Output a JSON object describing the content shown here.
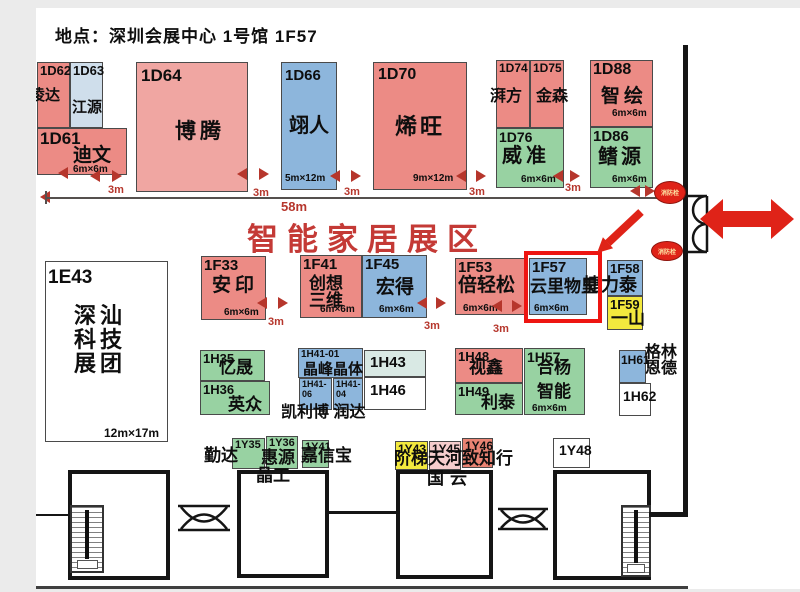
{
  "title": "地点：深圳会展中心 1号馆 1F57",
  "banner": {
    "text": "智能家居展区"
  },
  "fire_hydrant_label": "消防栓",
  "highlight": {
    "booth": "1F57",
    "x": 524,
    "y": 251,
    "w": 78,
    "h": 72
  },
  "colors": {
    "salmon": "#ec8b85",
    "salmon_light": "#f0a6a2",
    "salmon_deep": "#e98373",
    "blue": "#8db6dc",
    "paleblue": "#cfdeeb",
    "palecyan": "#d9e9e4",
    "green": "#98d2a2",
    "yellow": "#f3e93e",
    "palepink": "#f6cdcd",
    "white": "#ffffff",
    "accent_red": "#df2318",
    "dim_red": "#b6362c",
    "banner_red": "#c43a36",
    "highlight_red": "#ee1511"
  },
  "booths": [
    {
      "id": "1D62",
      "nm": "凌达",
      "c": "salmon",
      "x": 37,
      "y": 62,
      "w": 33,
      "h": 66,
      "ifs": 13,
      "nfs": 15,
      "nx": -8,
      "ny": 25
    },
    {
      "id": "1D63",
      "nm": "江源",
      "c": "paleblue",
      "x": 70,
      "y": 62,
      "w": 33,
      "h": 66,
      "ifs": 13,
      "nfs": 15,
      "nx": 1,
      "ny": 37
    },
    {
      "id": "1D61",
      "nm": "迪文",
      "sz": "6m×6m",
      "c": "salmon",
      "x": 37,
      "y": 128,
      "w": 90,
      "h": 47,
      "ifs": 17,
      "nfs": 19,
      "nx": 35,
      "ny": 17,
      "sx": 35,
      "sy": 36
    },
    {
      "id": "1D64",
      "nm": "博腾",
      "c": "salmon_light",
      "x": 136,
      "y": 62,
      "w": 112,
      "h": 130,
      "ifs": 17,
      "ix": 4,
      "iy": 4,
      "nfs": 21,
      "ls": 4,
      "nx": 38,
      "ny": 58
    },
    {
      "id": "1D66",
      "nm": "翊人",
      "sz": "5m×12m",
      "c": "blue",
      "x": 281,
      "y": 62,
      "w": 56,
      "h": 128,
      "ifs": 15,
      "ix": 3,
      "iy": 5,
      "nfs": 20,
      "nx": 7,
      "ny": 53,
      "sx": 3,
      "sy": 111
    },
    {
      "id": "1D70",
      "nm": "烯旺",
      "sz": "9m×12m",
      "c": "salmon",
      "x": 373,
      "y": 62,
      "w": 94,
      "h": 128,
      "ifs": 16,
      "ix": 4,
      "iy": 4,
      "nfs": 22,
      "ls": 3,
      "nx": 21,
      "ny": 52,
      "sx": 39,
      "sy": 111
    },
    {
      "id": "1D74",
      "nm": "湃方",
      "c": "salmon",
      "x": 496,
      "y": 60,
      "w": 34,
      "h": 68,
      "ifs": 12,
      "nfs": 16,
      "nx": -7,
      "ny": 28
    },
    {
      "id": "1D75",
      "nm": "金森",
      "c": "salmon",
      "x": 530,
      "y": 60,
      "w": 34,
      "h": 68,
      "ifs": 12,
      "nfs": 16,
      "nx": 5,
      "ny": 28
    },
    {
      "id": "1D76",
      "nm": "威准",
      "sz": "6m×6m",
      "c": "green",
      "x": 496,
      "y": 128,
      "w": 68,
      "h": 60,
      "ifs": 14,
      "nfs": 20,
      "ls": 4,
      "nx": 5,
      "ny": 17,
      "sx": 24,
      "sy": 46
    },
    {
      "id": "1D88",
      "nm": "智绘",
      "sz": "6m×6m",
      "c": "salmon",
      "x": 590,
      "y": 60,
      "w": 63,
      "h": 67,
      "ifs": 16,
      "nfs": 19,
      "ls": 4,
      "nx": 10,
      "ny": 26,
      "sx": 21,
      "sy": 48
    },
    {
      "id": "1D86",
      "nm": "鳍源",
      "sz": "6m×6m",
      "c": "green",
      "x": 590,
      "y": 127,
      "w": 63,
      "h": 61,
      "ifs": 15,
      "nfs": 20,
      "ls": 3,
      "nx": 7,
      "ny": 19,
      "sx": 21,
      "sy": 47
    },
    {
      "id": "1E43",
      "nm": [
        "深汕",
        "科技",
        "展团"
      ],
      "sz": "12m×17m",
      "c": "white",
      "x": 45,
      "y": 261,
      "w": 123,
      "h": 181,
      "ifs": 19,
      "ix": 2,
      "iy": 6,
      "nfs": 22,
      "ls": 4,
      "nx": 28,
      "ny": 42,
      "lh": 24,
      "sfs": 12,
      "sx": 58,
      "sy": 165
    },
    {
      "id": "1F33",
      "nm": "安印",
      "sz": "6m×6m",
      "c": "salmon",
      "x": 201,
      "y": 256,
      "w": 65,
      "h": 64,
      "ifs": 15,
      "nfs": 19,
      "ls": 4,
      "nx": 10,
      "ny": 19,
      "sx": 22,
      "sy": 51
    },
    {
      "id": "1F41",
      "nm": [
        "创想",
        "三维"
      ],
      "sz": "6m×6m",
      "c": "salmon",
      "x": 300,
      "y": 255,
      "w": 62,
      "h": 63,
      "ifs": 15,
      "nfs": 17,
      "nx": 8,
      "ny": 19,
      "lh": 17,
      "sx": 19,
      "sy": 49
    },
    {
      "id": "1F45",
      "nm": "宏得",
      "sz": "6m×6m",
      "c": "blue",
      "x": 362,
      "y": 255,
      "w": 65,
      "h": 63,
      "ifs": 15,
      "nfs": 19,
      "nx": 13,
      "ny": 22,
      "sx": 16,
      "sy": 49
    },
    {
      "id": "1F53",
      "nm": "倍轻松",
      "sz": "6m×6m",
      "c": "salmon",
      "x": 455,
      "y": 258,
      "w": 70,
      "h": 57,
      "ifs": 15,
      "nfs": 19,
      "nx": 2,
      "ny": 17,
      "sx": 7,
      "sy": 45
    },
    {
      "id": "1F57",
      "nm": "云里物里",
      "sz": "6m×6m",
      "c": "blue",
      "x": 529,
      "y": 258,
      "w": 58,
      "h": 57,
      "ifs": 15,
      "nfs": 17,
      "nx": 0,
      "ny": 19,
      "sx": 4,
      "sy": 45
    },
    {
      "id": "1F58",
      "c": "blue",
      "x": 607,
      "y": 260,
      "w": 36,
      "h": 36,
      "ifs": 13
    },
    {
      "id": "1F59",
      "nm": "一山",
      "c": "yellow",
      "x": 607,
      "y": 296,
      "w": 36,
      "h": 34,
      "ifs": 13,
      "nfs": 17,
      "nx": 3,
      "ny": 13
    },
    {
      "id": "1H35",
      "nm": "忆晟",
      "c": "green",
      "x": 200,
      "y": 350,
      "w": 65,
      "h": 31,
      "ifs": 13,
      "nfs": 17,
      "nx": 18,
      "ny": 8
    },
    {
      "id": "1H36",
      "nm": "英众",
      "c": "green",
      "x": 200,
      "y": 381,
      "w": 70,
      "h": 34,
      "ifs": 13,
      "nfs": 17,
      "nx": 27,
      "ny": 14
    },
    {
      "id": "1H41-01",
      "nm": "晶峰晶体",
      "c": "blue",
      "x": 298,
      "y": 348,
      "w": 65,
      "h": 30,
      "ifs": 10,
      "nfs": 15,
      "nx": 4,
      "ny": 13
    },
    {
      "id": "1H43",
      "c": "palecyan",
      "x": 364,
      "y": 350,
      "w": 62,
      "h": 27,
      "ifs": 15,
      "ix": 5,
      "iy": 4
    },
    {
      "id": "1H41-",
      "id2": "06",
      "c": "blue",
      "x": 299,
      "y": 378,
      "w": 33,
      "h": 32,
      "ifs": 9
    },
    {
      "id": "1H41-",
      "id2": "04",
      "c": "blue",
      "x": 333,
      "y": 378,
      "w": 30,
      "h": 32,
      "ifs": 9
    },
    {
      "id": "1H46",
      "c": "white",
      "x": 364,
      "y": 377,
      "w": 62,
      "h": 33,
      "ifs": 15,
      "ix": 5,
      "iy": 5
    },
    {
      "id": "1H48",
      "nm": "视鑫",
      "c": "salmon",
      "x": 455,
      "y": 348,
      "w": 68,
      "h": 35,
      "ifs": 13,
      "nfs": 17,
      "nx": 13,
      "ny": 10
    },
    {
      "id": "1H49",
      "nm": "利泰",
      "c": "green",
      "x": 455,
      "y": 383,
      "w": 68,
      "h": 32,
      "ifs": 13,
      "nfs": 17,
      "nx": 25,
      "ny": 10
    },
    {
      "id": "1H57",
      "nm": [
        "合杨",
        "智能"
      ],
      "sz": "6m×6m",
      "c": "green",
      "x": 524,
      "y": 348,
      "w": 61,
      "h": 67,
      "ifs": 14,
      "nfs": 17,
      "nx": 12,
      "ny": 10,
      "lh": 24,
      "sx": 7,
      "sy": 55
    },
    {
      "id": "1H61",
      "c": "blue",
      "x": 619,
      "y": 350,
      "w": 27,
      "h": 33,
      "ifs": 12,
      "ix": 1,
      "iy": 3
    },
    {
      "id": "1H62",
      "c": "white",
      "x": 619,
      "y": 383,
      "w": 32,
      "h": 33,
      "ifs": 14,
      "ix": 3,
      "iy": 5
    },
    {
      "id": "1Y35",
      "c": "green",
      "x": 232,
      "y": 438,
      "w": 33,
      "h": 31,
      "ifs": 11
    },
    {
      "id": "1Y36",
      "c": "green",
      "x": 266,
      "y": 436,
      "w": 32,
      "h": 33,
      "ifs": 11
    },
    {
      "id": "1Y41",
      "c": "green",
      "x": 302,
      "y": 440,
      "w": 27,
      "h": 28,
      "ifs": 11
    },
    {
      "id": "1Y43",
      "c": "yellow",
      "x": 395,
      "y": 441,
      "w": 33,
      "h": 29,
      "ifs": 12
    },
    {
      "id": "1Y45",
      "c": "palepink",
      "x": 429,
      "y": 441,
      "w": 32,
      "h": 29,
      "ifs": 12
    },
    {
      "id": "1Y46",
      "c": "salmon_deep",
      "x": 462,
      "y": 438,
      "w": 31,
      "h": 30,
      "ifs": 12
    },
    {
      "id": "1Y48",
      "c": "white",
      "x": 553,
      "y": 438,
      "w": 37,
      "h": 30,
      "ifs": 14,
      "ix": 5,
      "iy": 4
    }
  ],
  "overlays": [
    {
      "t": "捷力泰",
      "x": 583,
      "y": 276,
      "fs": 18
    },
    {
      "t": "格林",
      "x": 645,
      "y": 345,
      "fs": 16
    },
    {
      "t": "恩德",
      "x": 645,
      "y": 361,
      "fs": 16
    },
    {
      "t": "凯利博 润达",
      "x": 281,
      "y": 405,
      "fs": 16
    },
    {
      "t": "勤达",
      "x": 204,
      "y": 447,
      "fs": 17
    },
    {
      "t": "惠源",
      "x": 261,
      "y": 449,
      "fs": 17
    },
    {
      "t": "嘉信宝",
      "x": 301,
      "y": 447,
      "fs": 17
    },
    {
      "t": "晶工",
      "x": 256,
      "y": 467,
      "fs": 17
    },
    {
      "t": "阶梯天河致知行",
      "x": 394,
      "y": 450,
      "fs": 17
    },
    {
      "t": "国云",
      "x": 427,
      "y": 470,
      "fs": 17,
      "ls": 6
    }
  ],
  "dim_labels": [
    {
      "t": "58m",
      "x": 281,
      "y": 200,
      "fs": 13
    },
    {
      "t": "3m",
      "x": 108,
      "y": 185
    },
    {
      "t": "3m",
      "x": 253,
      "y": 188
    },
    {
      "t": "3m",
      "x": 344,
      "y": 187
    },
    {
      "t": "3m",
      "x": 469,
      "y": 187
    },
    {
      "t": "3m",
      "x": 565,
      "y": 183
    },
    {
      "t": "3m",
      "x": 268,
      "y": 317
    },
    {
      "t": "3m",
      "x": 424,
      "y": 321
    },
    {
      "t": "3m",
      "x": 493,
      "y": 324
    }
  ],
  "tris": [
    {
      "x": 90,
      "y": 170,
      "d": "l"
    },
    {
      "x": 112,
      "y": 170,
      "d": "r"
    },
    {
      "x": 237,
      "y": 168,
      "d": "l"
    },
    {
      "x": 259,
      "y": 168,
      "d": "r"
    },
    {
      "x": 330,
      "y": 170,
      "d": "l"
    },
    {
      "x": 351,
      "y": 170,
      "d": "r"
    },
    {
      "x": 456,
      "y": 170,
      "d": "l"
    },
    {
      "x": 476,
      "y": 170,
      "d": "r"
    },
    {
      "x": 553,
      "y": 170,
      "d": "l"
    },
    {
      "x": 570,
      "y": 170,
      "d": "r"
    },
    {
      "x": 630,
      "y": 185,
      "d": "l"
    },
    {
      "x": 645,
      "y": 185,
      "d": "r"
    },
    {
      "x": 58,
      "y": 167,
      "d": "l"
    },
    {
      "x": 40,
      "y": 191,
      "d": "l"
    },
    {
      "x": 257,
      "y": 297,
      "d": "l"
    },
    {
      "x": 278,
      "y": 297,
      "d": "r"
    },
    {
      "x": 417,
      "y": 297,
      "d": "l"
    },
    {
      "x": 436,
      "y": 297,
      "d": "r"
    },
    {
      "x": 492,
      "y": 300,
      "d": "l"
    },
    {
      "x": 512,
      "y": 300,
      "d": "r"
    }
  ],
  "walls": [
    {
      "x": 683,
      "y": 45,
      "w": 5,
      "h": 472
    },
    {
      "x": 649,
      "y": 512,
      "w": 39,
      "h": 5
    },
    {
      "x": 36,
      "y": 514,
      "w": 32,
      "h": 2
    },
    {
      "x": 329,
      "y": 511,
      "w": 68,
      "h": 3
    },
    {
      "x": 45,
      "y": 197,
      "w": 623,
      "h": 2,
      "c": "#55504e"
    },
    {
      "x": 45,
      "y": 191,
      "w": 2,
      "h": 13,
      "c": "#55504e"
    },
    {
      "x": 36,
      "y": 586,
      "w": 652,
      "h": 3,
      "c": "#3f3f3f"
    }
  ],
  "rooms": [
    {
      "x": 68,
      "y": 470,
      "w": 102,
      "h": 110
    },
    {
      "x": 237,
      "y": 470,
      "w": 92,
      "h": 108
    },
    {
      "x": 396,
      "y": 470,
      "w": 97,
      "h": 109
    },
    {
      "x": 553,
      "y": 470,
      "w": 98,
      "h": 110
    }
  ],
  "stairs": [
    {
      "x": 70,
      "y": 505,
      "w": 34,
      "h": 68
    },
    {
      "x": 621,
      "y": 505,
      "w": 30,
      "h": 72
    }
  ],
  "hydrants": [
    {
      "x": 654,
      "y": 181,
      "w": 30,
      "h": 21
    },
    {
      "x": 651,
      "y": 241,
      "w": 30,
      "h": 18
    }
  ]
}
